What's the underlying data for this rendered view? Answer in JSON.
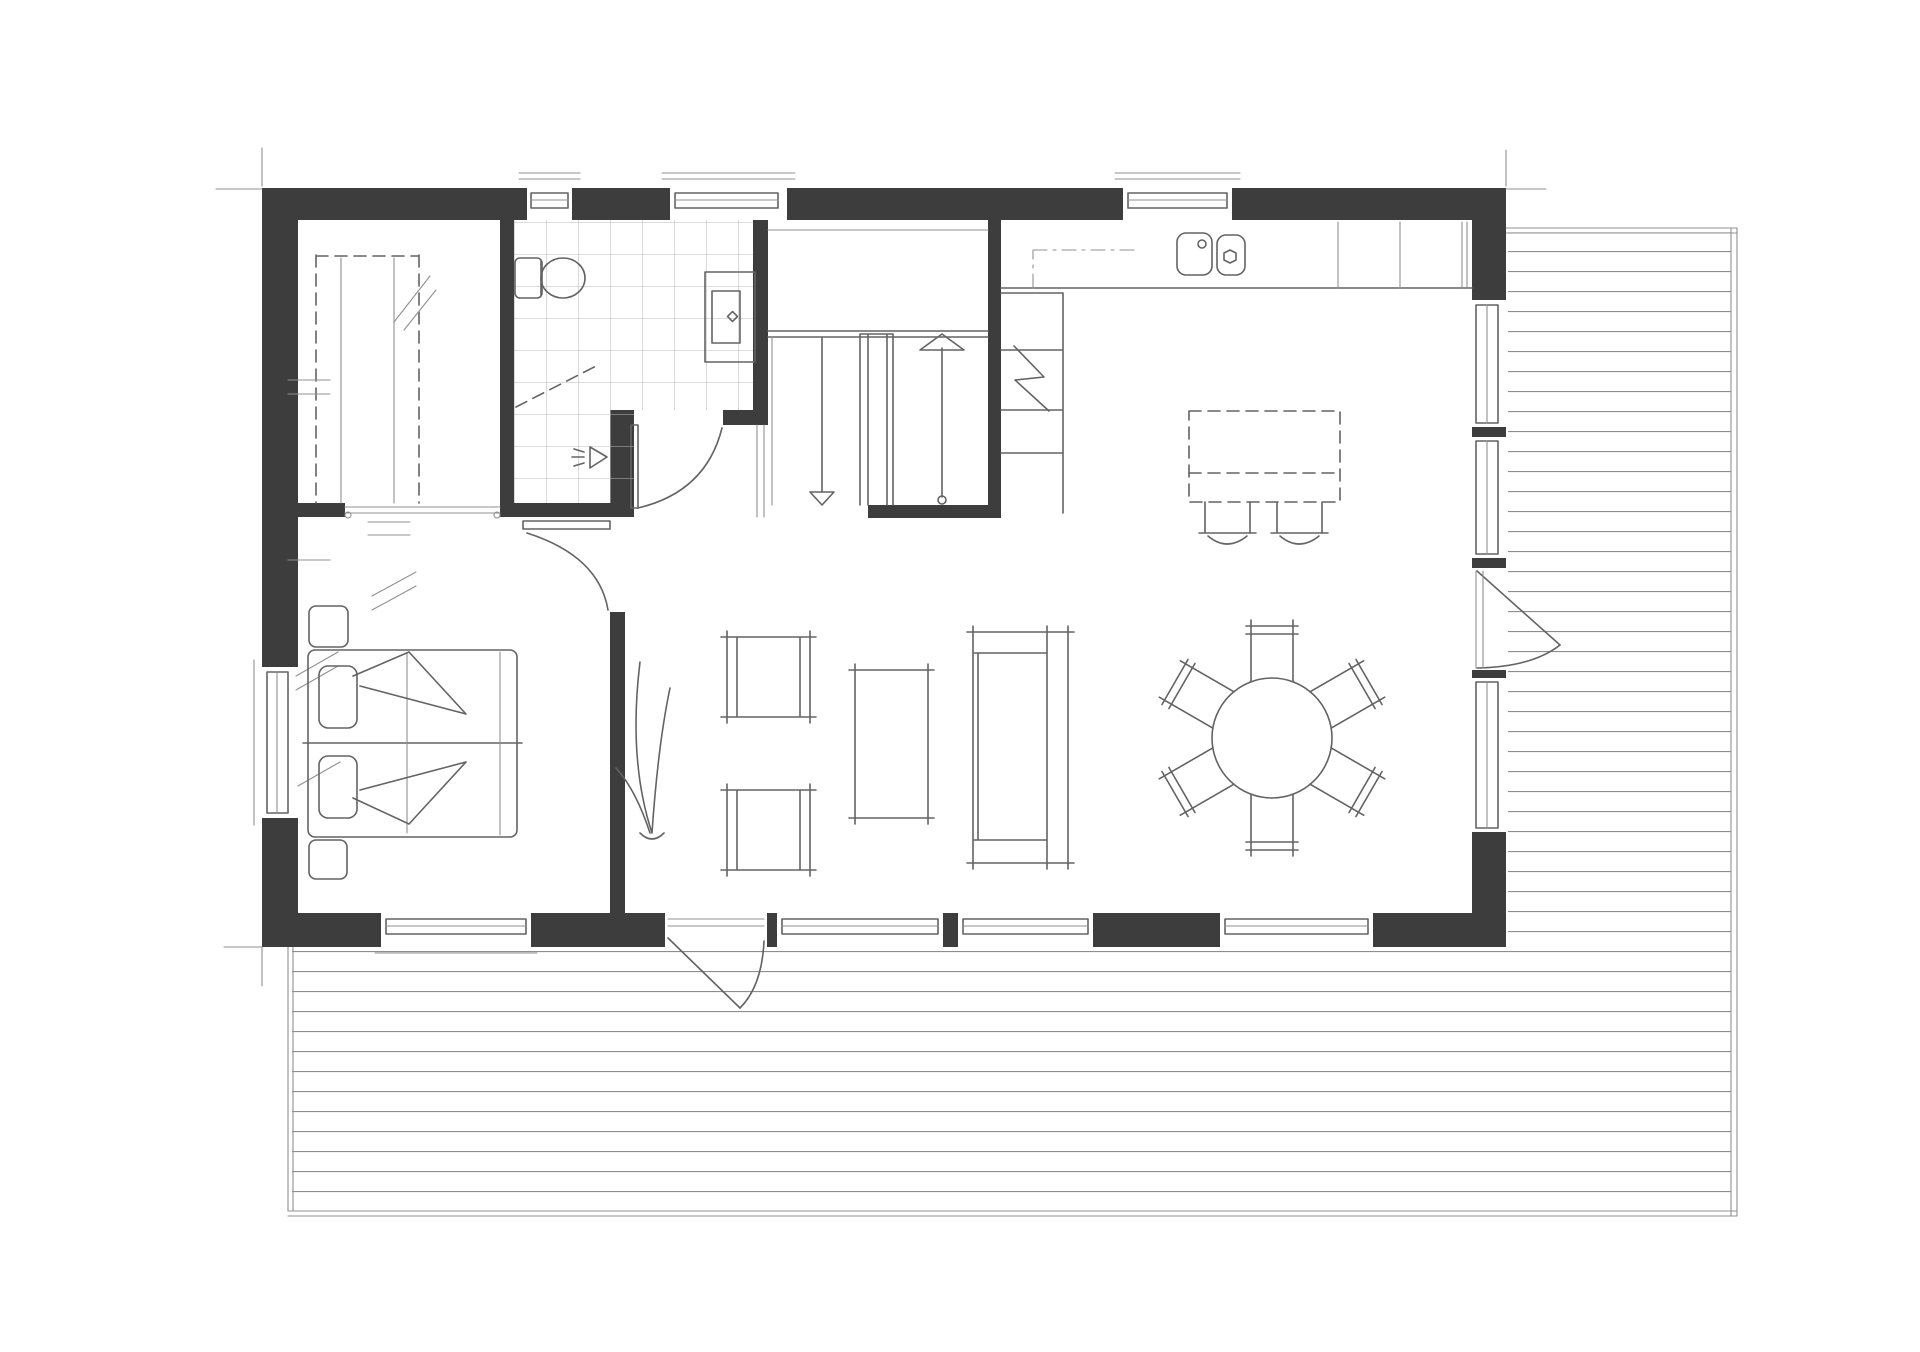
{
  "document": {
    "kind": "architectural-floor-plan",
    "style": "hand-drawn monochrome sketch, top-down single storey plan with wrap-around wooden deck",
    "visible_text": ""
  },
  "colors": {
    "background": "#ffffff",
    "walls": "#3d3d3d",
    "lines": "#636363",
    "light_lines": "#909090",
    "tiles": "#b9b9b9",
    "deck": "#8d8d8d"
  },
  "rooms": [
    {
      "name": "walk-in-closet",
      "features": [
        "dashed wardrobe shelving on both sides",
        "hash marks for hanging rails",
        "open doorway to bedroom"
      ]
    },
    {
      "name": "bathroom",
      "features": [
        "square floor tiles",
        "toilet",
        "vanity with basin",
        "floor drain",
        "dashed shower screen",
        "door to hallway"
      ]
    },
    {
      "name": "hallway-with-stairs",
      "features": [
        "double-run staircase",
        "up arrow",
        "down arrow",
        "center railing"
      ]
    },
    {
      "name": "kitchen",
      "features": [
        "counter along top wall",
        "double sink",
        "tall cabinet column",
        "refrigerator zigzag symbol",
        "dash-dot wall cabinets",
        "dashed island with two bar stools"
      ]
    },
    {
      "name": "dining-area",
      "features": [
        "round table",
        "six chairs in hexagon arrangement"
      ]
    },
    {
      "name": "living-room",
      "features": [
        "sofa",
        "coffee table",
        "two armchairs",
        "floor plant"
      ]
    },
    {
      "name": "bedroom",
      "features": [
        "double bed with two pillows and folded duvets",
        "two nightstands",
        "window to left",
        "window to deck"
      ]
    },
    {
      "name": "deck",
      "features": [
        "plank boards drawn as parallel lines",
        "wraps right side and full bottom width"
      ]
    }
  ],
  "fixtures": {
    "toilet": 1,
    "vanity_sink": 1,
    "floor_drain": 1,
    "kitchen_sink_basins": 2,
    "refrigerator": 1,
    "kitchen_island": 1,
    "bar_stools": 2,
    "staircase_runs": 2
  },
  "furniture": {
    "double_bed": 1,
    "pillows": 2,
    "nightstands": 2,
    "sofa": 1,
    "coffee_table": 1,
    "armchairs": 2,
    "floor_plant": 1,
    "dining_table": 1,
    "dining_chairs": 6
  },
  "openings": {
    "windows_top_wall": 3,
    "windows_bottom_wall": 4,
    "windows_left_wall": 1,
    "windows_right_wall": 3,
    "exterior_doors": [
      "door to deck in right wall",
      "door to deck in bottom wall"
    ],
    "interior_doors": [
      "bathroom door",
      "bedroom door"
    ],
    "cased_openings": [
      "closet entrance",
      "hall to living room passage"
    ]
  }
}
